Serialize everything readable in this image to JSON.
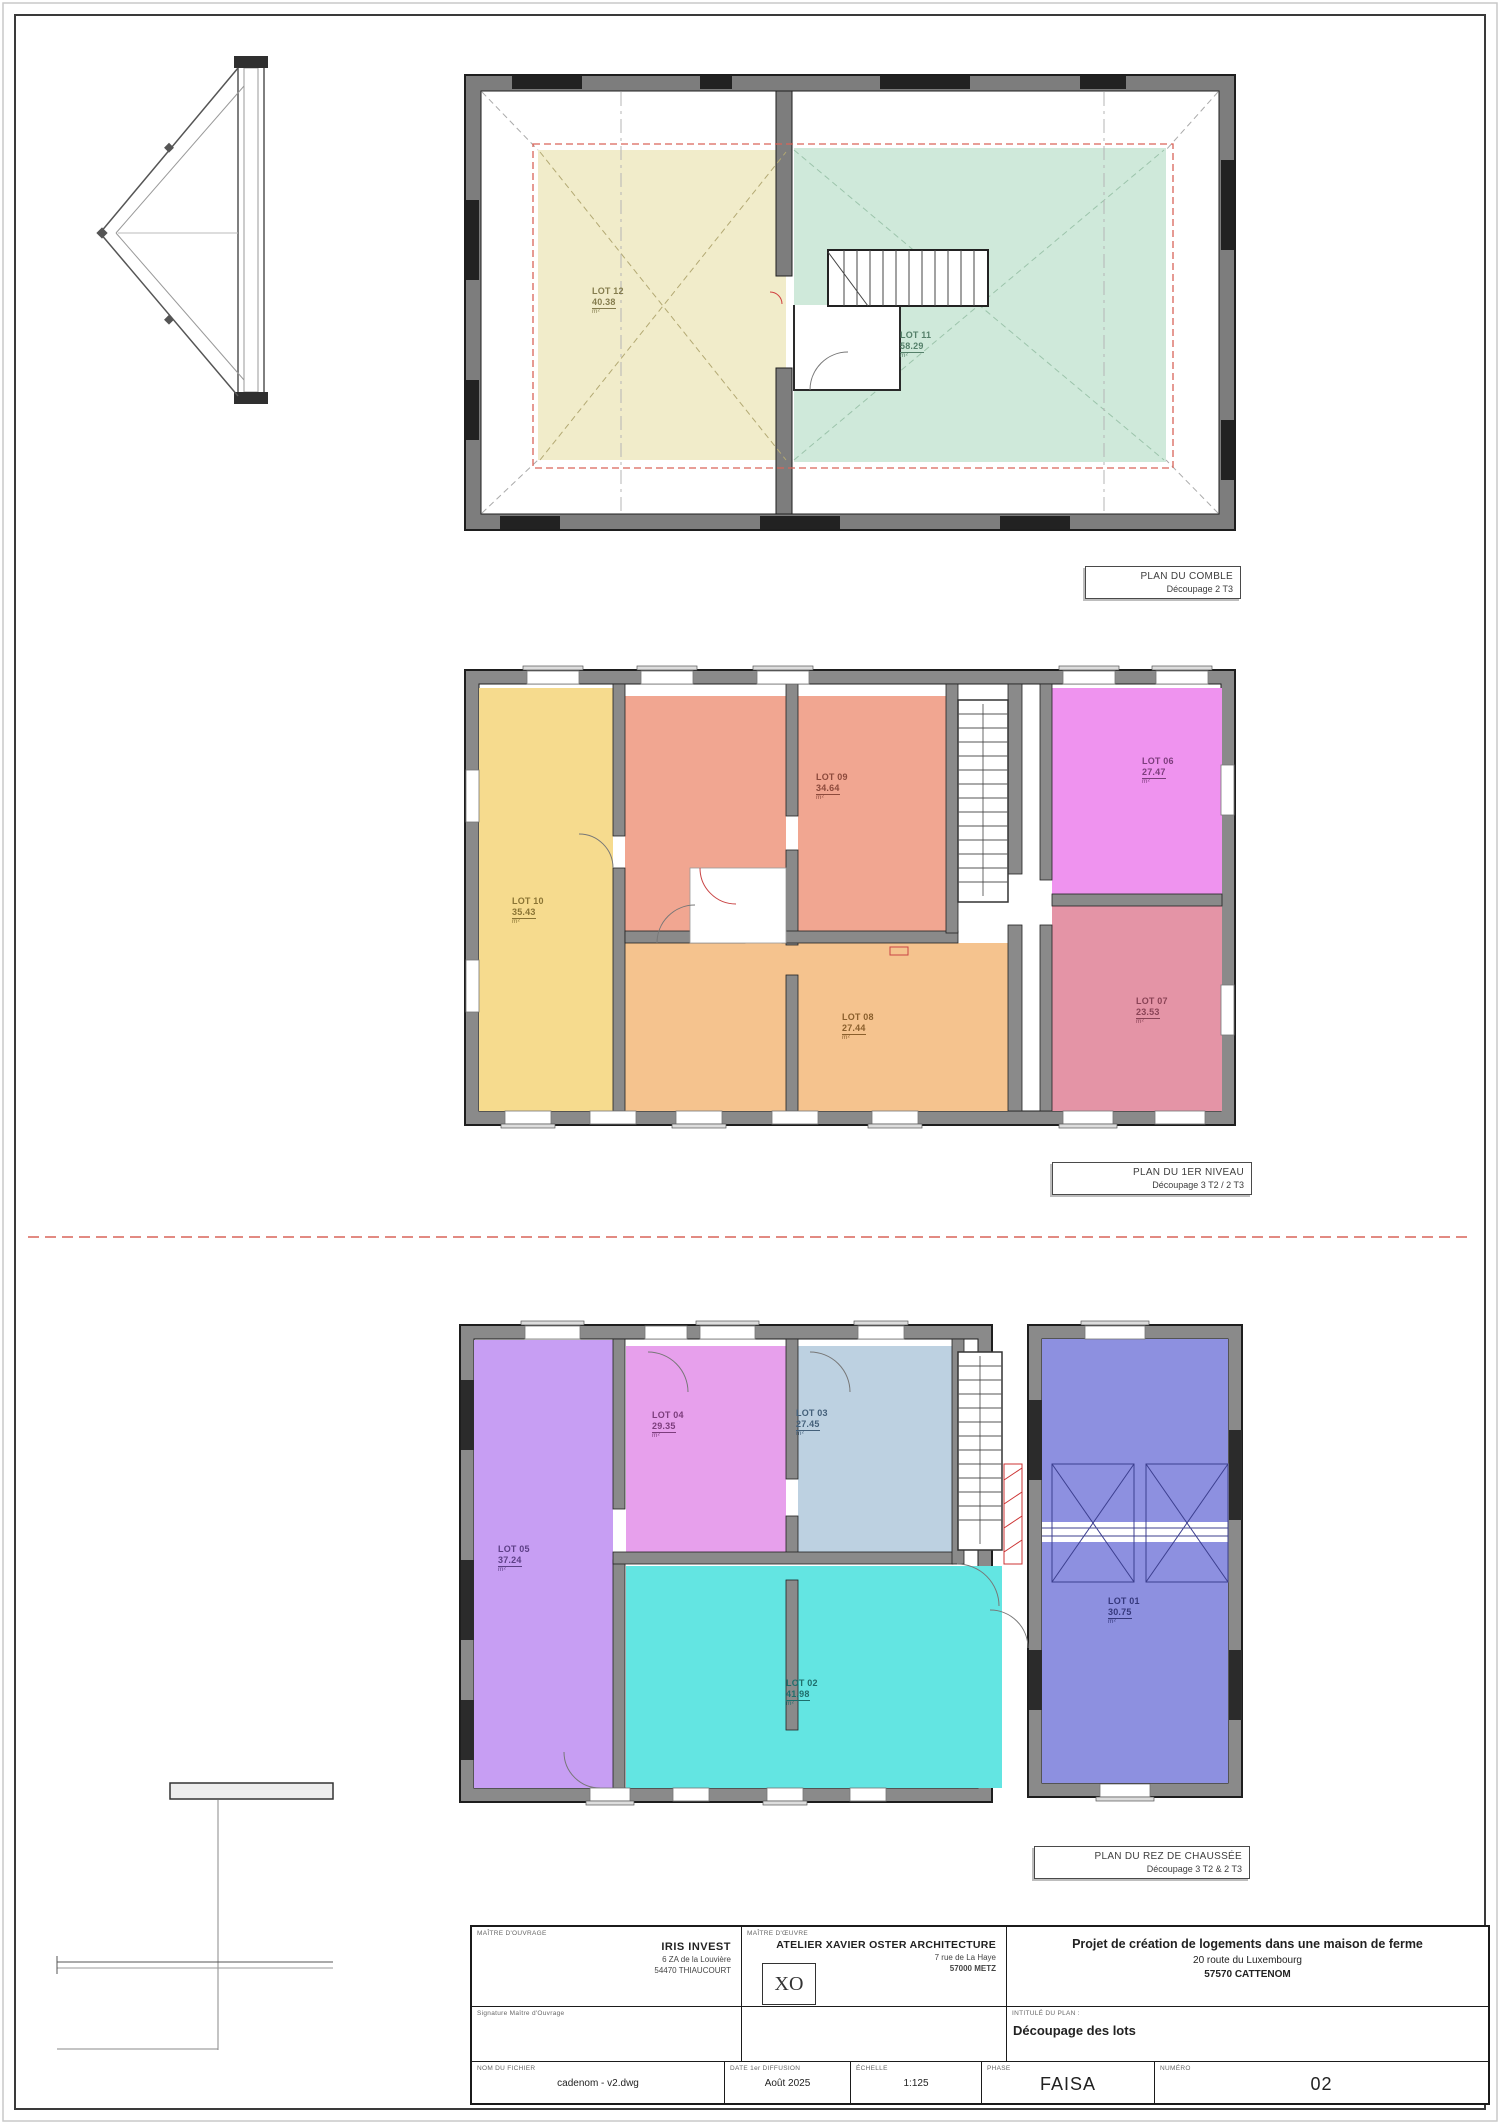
{
  "units": {
    "area": "m²"
  },
  "plans": {
    "comble": {
      "caption_title": "PLAN DU COMBLE",
      "caption_subtitle": "Découpage 2 T3",
      "lots": [
        {
          "id": "LOT 12",
          "area": "40.38",
          "color": "#f1ecca"
        },
        {
          "id": "LOT 11",
          "area": "58.29",
          "color": "#cfe9da"
        }
      ]
    },
    "niveau1": {
      "caption_title": "PLAN DU 1ER NIVEAU",
      "caption_subtitle": "Découpage 3 T2 / 2 T3",
      "lots": [
        {
          "id": "LOT 10",
          "area": "35.43",
          "color": "#f6db8e"
        },
        {
          "id": "LOT 09",
          "area": "34.64",
          "color": "#f1a691"
        },
        {
          "id": "LOT 06",
          "area": "27.47",
          "color": "#ef93ef"
        },
        {
          "id": "LOT 08",
          "area": "27.44",
          "color": "#f5c38e"
        },
        {
          "id": "LOT 07",
          "area": "23.53",
          "color": "#e494a6"
        }
      ]
    },
    "rdc": {
      "caption_title": "PLAN DU REZ DE CHAUSSÉE",
      "caption_subtitle": "Découpage 3 T2 & 2 T3",
      "lots": [
        {
          "id": "LOT 05",
          "area": "37.24",
          "color": "#c79ef3"
        },
        {
          "id": "LOT 04",
          "area": "29.35",
          "color": "#e7a0ec"
        },
        {
          "id": "LOT 03",
          "area": "27.45",
          "color": "#bdd1e1"
        },
        {
          "id": "LOT 02",
          "area": "41.98",
          "color": "#63e5e2"
        },
        {
          "id": "LOT 01",
          "area": "30.75",
          "color": "#8d90e0"
        }
      ]
    }
  },
  "title_block": {
    "owner_label": "MAÎTRE D'OUVRAGE",
    "owner_name": "IRIS INVEST",
    "owner_address1": "6 ZA de la Louvière",
    "owner_address2": "54470 THIAUCOURT",
    "architect_label": "MAÎTRE D'ŒUVRE",
    "architect_logo": "XO",
    "architect_name": "ATELIER XAVIER OSTER ARCHITECTURE",
    "architect_address1": "7 rue de La Haye",
    "architect_address2": "57000 METZ",
    "project_line1": "Projet de création de logements dans une maison de ferme",
    "project_line2": "20 route du Luxembourg",
    "project_line3": "57570 CATTENOM",
    "signature_label": "Signature Maître d'Ouvrage",
    "plan_name_label": "INTITULÉ DU PLAN :",
    "plan_name": "Découpage des lots",
    "file_label": "NOM DU FICHIER",
    "file_value": "cadenom - v2.dwg",
    "date_label": "DATE 1er DIFFUSION",
    "date_value": "Août 2025",
    "scale_label": "ÉCHELLE",
    "scale_value": "1:125",
    "phase_label": "PHASE",
    "phase_value": "FAISA",
    "number_label": "NUMÉRO",
    "number_value": "02"
  }
}
